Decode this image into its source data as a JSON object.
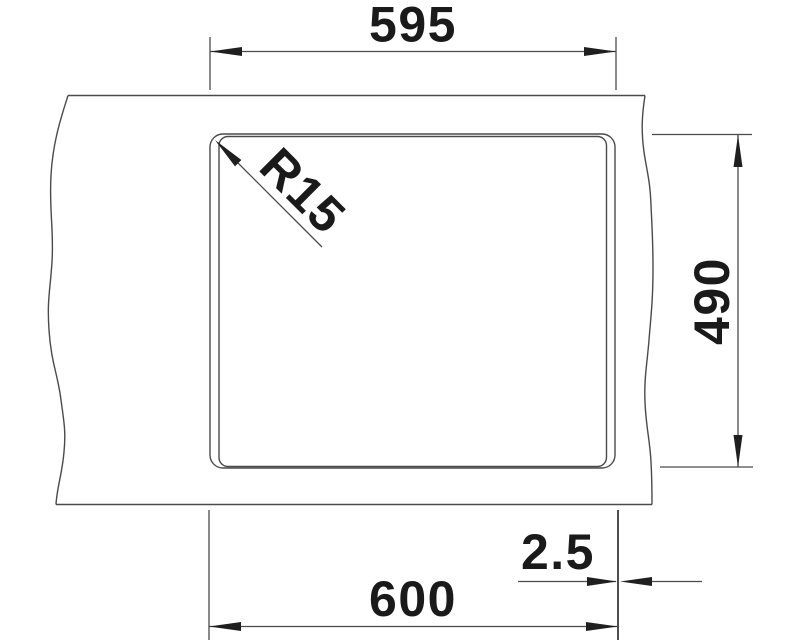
{
  "drawing": {
    "kind": "sink-installation-dimension-drawing",
    "dimension_labels": {
      "top_width": "595",
      "height": "490",
      "bottom_width": "600",
      "edge_reveal": "2.5",
      "corner_radius": "R15"
    },
    "colors": {
      "background": "#ffffff",
      "line": "#4a4a4a",
      "arrow_and_text": "#1f1f1f"
    }
  }
}
